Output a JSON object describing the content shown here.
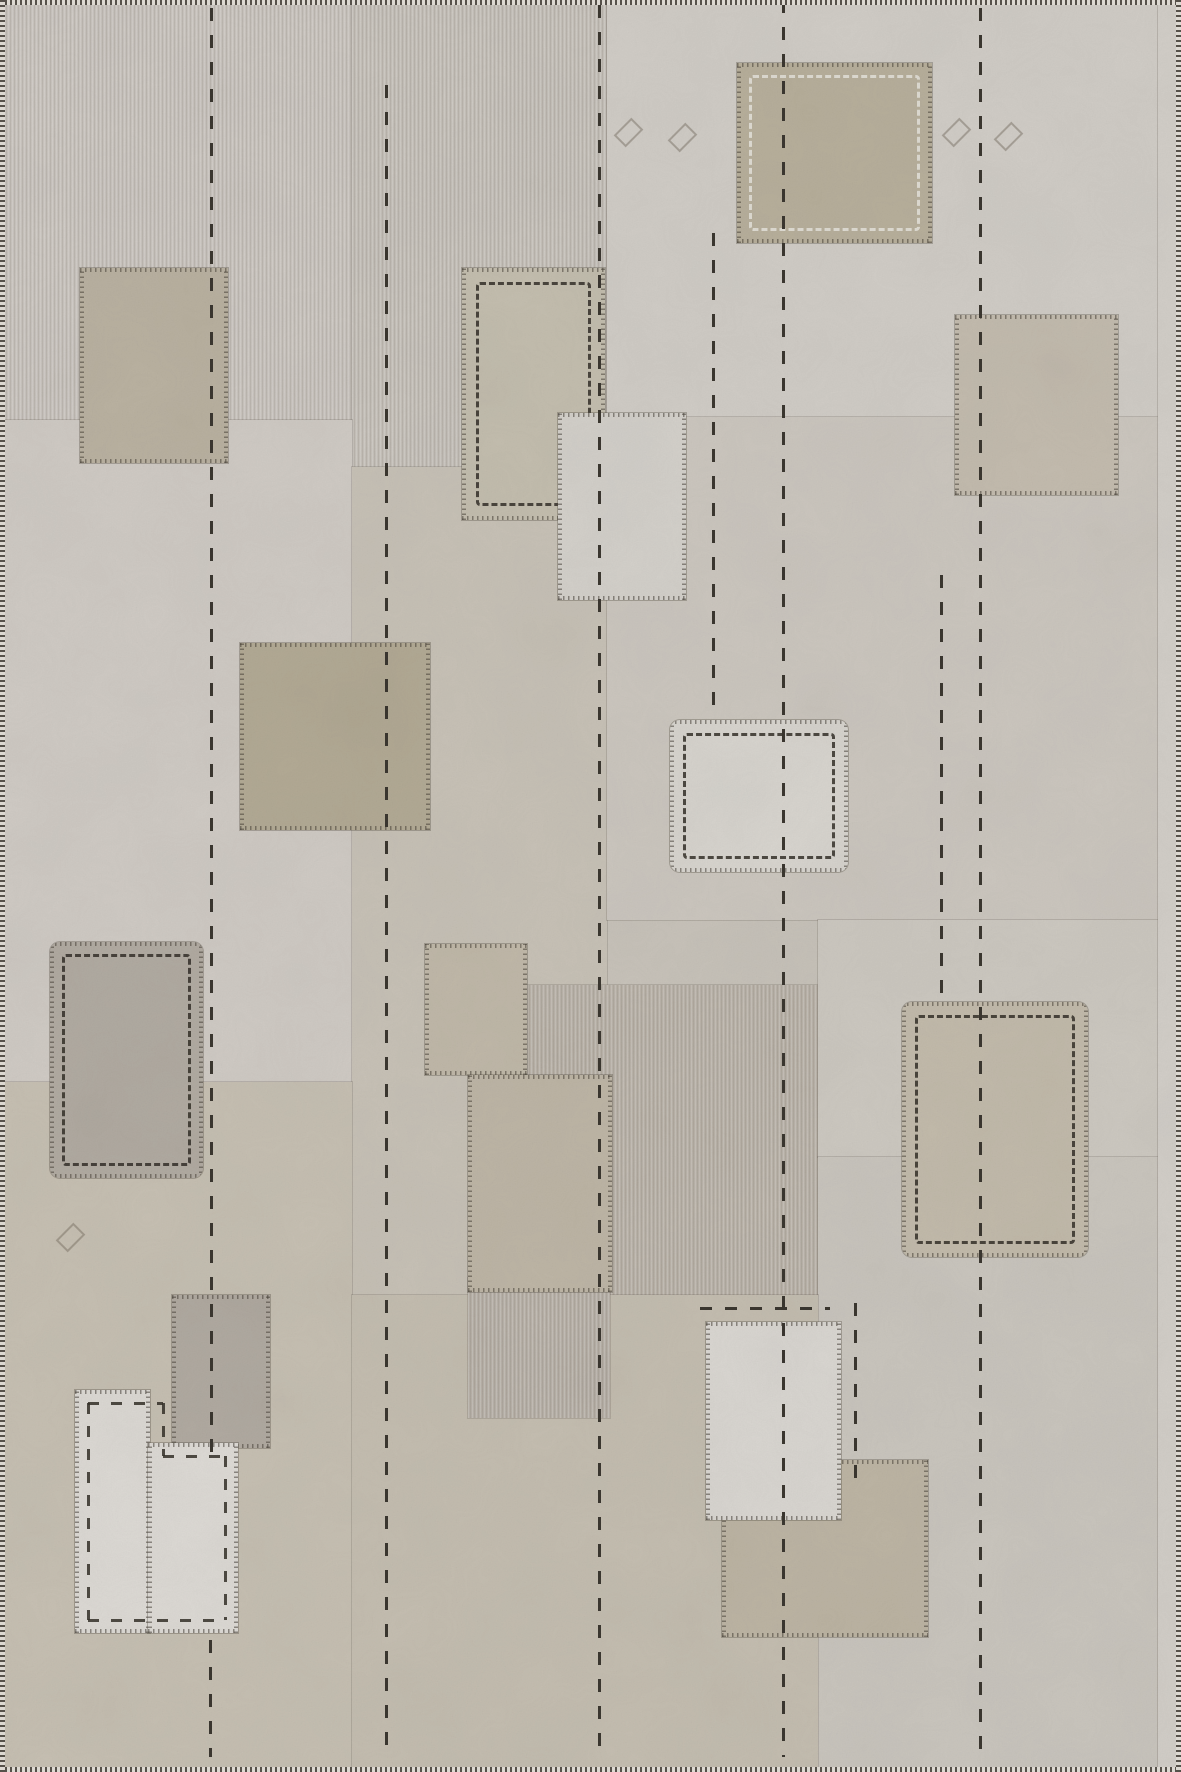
{
  "image": {
    "type": "photograph",
    "subject": "vintage patchwork kilim rug seen flat from above",
    "description": "Flat-woven rug collaged from sun-faded greige wool panels with applique rectangular patches, long vertical running-stitch lines, dashed stitched borders and whip-stitched edges.",
    "palette": {
      "base": "#c7c2b9",
      "light_patch": "#d9d6d1",
      "olive_patch": "#b4ab97",
      "gray_patch": "#b1aaa1",
      "stitch": "#3a362f",
      "edge_dark": "#56514a",
      "edge_light": "#ddd9d2"
    }
  },
  "scene": {
    "canvas": {
      "width": 1181,
      "height": 1772
    },
    "panels": [
      {
        "name": "panel-top-left",
        "x": 0,
        "y": 0,
        "w": 352,
        "h": 420,
        "color": "#c9c4be",
        "streaks": true
      },
      {
        "name": "panel-top-middle",
        "x": 352,
        "y": 0,
        "w": 255,
        "h": 467,
        "color": "#c5c0b9",
        "streaks": true
      },
      {
        "name": "panel-top-right",
        "x": 607,
        "y": 0,
        "w": 574,
        "h": 417,
        "color": "#d0ccc6",
        "streaks": false
      },
      {
        "name": "panel-mid-left",
        "x": 0,
        "y": 420,
        "w": 352,
        "h": 662,
        "color": "#cfcac4",
        "streaks": false
      },
      {
        "name": "panel-mid-column",
        "x": 352,
        "y": 467,
        "w": 255,
        "h": 828,
        "color": "#c7c1b6",
        "streaks": false
      },
      {
        "name": "panel-mid-right",
        "x": 607,
        "y": 417,
        "w": 574,
        "h": 503,
        "color": "#cbc6be",
        "streaks": false
      },
      {
        "name": "panel-bottom-left",
        "x": 0,
        "y": 1082,
        "w": 352,
        "h": 690,
        "color": "#c6bfb2",
        "streaks": false
      },
      {
        "name": "panel-center-dark-field",
        "x": 527,
        "y": 985,
        "w": 291,
        "h": 310,
        "color": "#bab3a9",
        "streaks": true
      },
      {
        "name": "panel-right-upper",
        "x": 818,
        "y": 920,
        "w": 363,
        "h": 237,
        "color": "#ccc8c0",
        "streaks": false
      },
      {
        "name": "panel-right-lower",
        "x": 818,
        "y": 1157,
        "w": 363,
        "h": 615,
        "color": "#c9c5bd",
        "streaks": false
      },
      {
        "name": "panel-bottom-center",
        "x": 352,
        "y": 1295,
        "w": 466,
        "h": 477,
        "color": "#c4bdb0",
        "streaks": false
      },
      {
        "name": "panel-small-gray-block",
        "x": 468,
        "y": 1278,
        "w": 142,
        "h": 140,
        "color": "#b8b1a8",
        "streaks": true
      },
      {
        "name": "panel-right-selvage-strip",
        "x": 1158,
        "y": 0,
        "w": 23,
        "h": 1772,
        "color": "#d2cec8",
        "streaks": false
      }
    ],
    "patches": [
      {
        "name": "patch-top-left-tan",
        "x": 80,
        "y": 268,
        "w": 148,
        "h": 195,
        "color": "#b9b1a0"
      },
      {
        "name": "patch-upper-middle-dashed",
        "x": 462,
        "y": 268,
        "w": 143,
        "h": 252,
        "color": "#c3bdae",
        "dash_inset": 14
      },
      {
        "name": "patch-top-right-olive",
        "x": 737,
        "y": 63,
        "w": 195,
        "h": 180,
        "color": "#b7af9b",
        "dash_inset": 12,
        "dash_color": "light"
      },
      {
        "name": "patch-center-upper-light",
        "x": 558,
        "y": 413,
        "w": 128,
        "h": 187,
        "color": "#d3d0ca"
      },
      {
        "name": "patch-right-taupe",
        "x": 955,
        "y": 315,
        "w": 163,
        "h": 180,
        "color": "#c3bbae"
      },
      {
        "name": "patch-mid-left-olive",
        "x": 240,
        "y": 643,
        "w": 190,
        "h": 187,
        "color": "#b2a994"
      },
      {
        "name": "patch-center-light-dashed",
        "x": 670,
        "y": 720,
        "w": 178,
        "h": 152,
        "color": "#d7d4ce",
        "dash_inset": 13,
        "rounded": true
      },
      {
        "name": "patch-left-gray-dashed",
        "x": 50,
        "y": 942,
        "w": 153,
        "h": 236,
        "color": "#b1aaa1",
        "dash_inset": 12,
        "rounded": true
      },
      {
        "name": "patch-center-burlap",
        "x": 425,
        "y": 944,
        "w": 102,
        "h": 131,
        "color": "#c0b8a8"
      },
      {
        "name": "patch-center-soft-tan",
        "x": 468,
        "y": 1075,
        "w": 144,
        "h": 217,
        "color": "#bdb5a5"
      },
      {
        "name": "patch-right-tan-dashed",
        "x": 902,
        "y": 1002,
        "w": 186,
        "h": 255,
        "color": "#c2baaa",
        "dash_inset": 13,
        "rounded": true
      },
      {
        "name": "patch-bottom-left-darkgray",
        "x": 172,
        "y": 1295,
        "w": 98,
        "h": 153,
        "color": "#b0a9a0"
      },
      {
        "name": "patch-bottom-tan",
        "x": 722,
        "y": 1460,
        "w": 206,
        "h": 177,
        "color": "#bcb4a3"
      },
      {
        "name": "patch-bottom-light",
        "x": 706,
        "y": 1322,
        "w": 135,
        "h": 198,
        "color": "#d9d6d1"
      },
      {
        "name": "patch-white-L-left-part",
        "x": 75,
        "y": 1390,
        "w": 75,
        "h": 243,
        "color": "#dcd9d4"
      },
      {
        "name": "patch-white-L-right-part",
        "x": 148,
        "y": 1443,
        "w": 90,
        "h": 190,
        "color": "#dcd9d4"
      }
    ],
    "stitch_lines_v": [
      {
        "name": "stitch-line-1",
        "x": 211,
        "y1": 8,
        "y2": 1455
      },
      {
        "name": "stitch-line-1b",
        "x": 210,
        "y1": 1640,
        "y2": 1757
      },
      {
        "name": "stitch-line-2",
        "x": 386,
        "y1": 85,
        "y2": 1757
      },
      {
        "name": "stitch-line-3",
        "x": 599,
        "y1": 5,
        "y2": 1757
      },
      {
        "name": "stitch-line-4",
        "x": 713,
        "y1": 233,
        "y2": 716
      },
      {
        "name": "stitch-line-5",
        "x": 783,
        "y1": 0,
        "y2": 1757
      },
      {
        "name": "stitch-line-6",
        "x": 941,
        "y1": 575,
        "y2": 998
      },
      {
        "name": "stitch-line-7",
        "x": 980,
        "y1": 8,
        "y2": 1757
      },
      {
        "name": "stitch-line-8",
        "x": 855,
        "y1": 1303,
        "y2": 1492
      }
    ],
    "stitch_lines_h": [
      {
        "name": "stitch-line-horizontal",
        "y": 1308,
        "x1": 700,
        "x2": 830
      }
    ],
    "l_patch_dashes": [
      {
        "name": "L-dash-top",
        "dir": "h",
        "x": 88,
        "y": 1403,
        "len": 75
      },
      {
        "name": "L-dash-step-down",
        "dir": "v",
        "x": 163,
        "y": 1403,
        "len": 53
      },
      {
        "name": "L-dash-step-right",
        "dir": "h",
        "x": 163,
        "y": 1456,
        "len": 62
      },
      {
        "name": "L-dash-right",
        "dir": "v",
        "x": 225,
        "y": 1456,
        "len": 164
      },
      {
        "name": "L-dash-bottom",
        "dir": "h",
        "x": 88,
        "y": 1620,
        "len": 137
      },
      {
        "name": "L-dash-left",
        "dir": "v",
        "x": 88,
        "y": 1403,
        "len": 217
      }
    ],
    "motifs": [
      {
        "name": "diamond-motif-1",
        "x": 620,
        "y": 120
      },
      {
        "name": "diamond-motif-2",
        "x": 674,
        "y": 125
      },
      {
        "name": "diamond-motif-3",
        "x": 948,
        "y": 120
      },
      {
        "name": "diamond-motif-4",
        "x": 1000,
        "y": 124
      },
      {
        "name": "diamond-motif-5",
        "x": 62,
        "y": 1225
      }
    ]
  }
}
